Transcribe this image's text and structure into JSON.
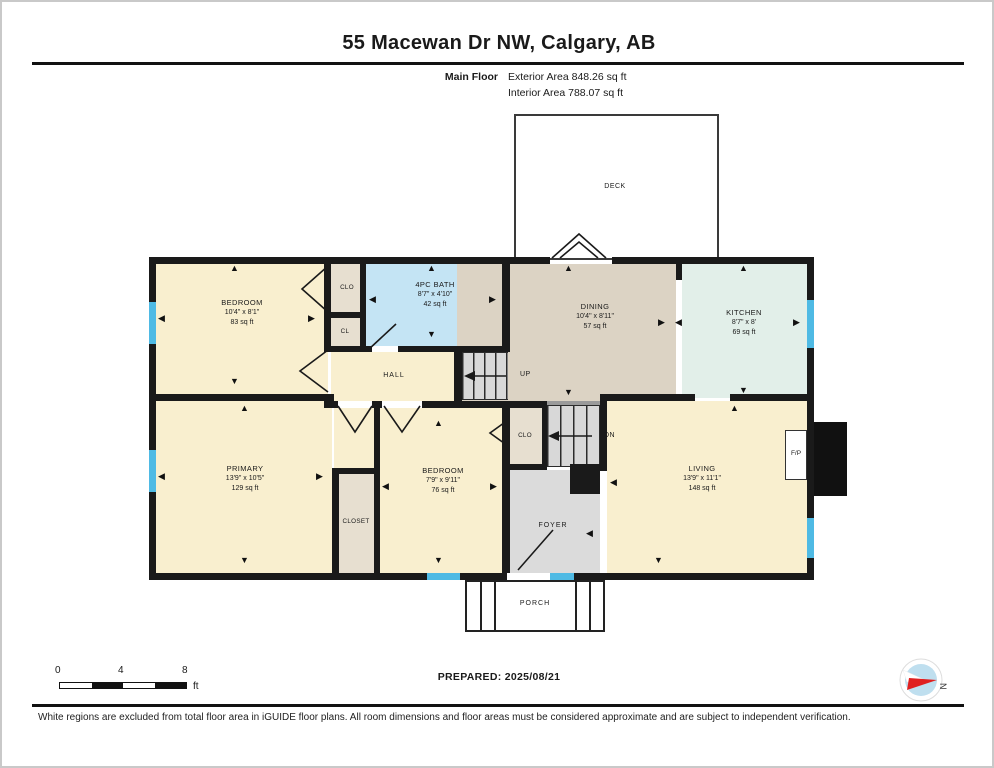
{
  "header": {
    "title": "55 Macewan Dr NW, Calgary, AB",
    "floor_label": "Main Floor",
    "exterior_area": "Exterior Area 848.26 sq ft",
    "interior_area": "Interior Area 788.07 sq ft"
  },
  "rooms": {
    "deck": {
      "name": "DECK"
    },
    "bedroom_top": {
      "name": "BEDROOM",
      "dims": "10'4\" x 8'1\"",
      "area": "83 sq ft"
    },
    "clo_top": {
      "name": "CLO"
    },
    "cl": {
      "name": "CL"
    },
    "bath": {
      "name": "4PC BATH",
      "dims": "8'7\" x 4'10\"",
      "area": "42 sq ft"
    },
    "dining": {
      "name": "DINING",
      "dims": "10'4\" x 8'11\"",
      "area": "57 sq ft"
    },
    "kitchen": {
      "name": "KITCHEN",
      "dims": "8'7\" x 8'",
      "area": "69 sq ft"
    },
    "hall": {
      "name": "HALL"
    },
    "up": {
      "name": "UP"
    },
    "dn": {
      "name": "DN"
    },
    "primary": {
      "name": "PRIMARY",
      "dims": "13'9\" x 10'5\"",
      "area": "129 sq ft"
    },
    "closet": {
      "name": "CLOSET"
    },
    "clo_mid": {
      "name": "CLO"
    },
    "bedroom_mid": {
      "name": "BEDROOM",
      "dims": "7'9\" x 9'11\"",
      "area": "76 sq ft"
    },
    "foyer": {
      "name": "FOYER"
    },
    "living": {
      "name": "LIVING",
      "dims": "13'9\" x 11'1\"",
      "area": "148 sq ft"
    },
    "fireplace": {
      "name": "F/P"
    },
    "porch": {
      "name": "PORCH"
    }
  },
  "footer": {
    "scale": {
      "t0": "0",
      "t4": "4",
      "t8": "8",
      "unit": "ft"
    },
    "prepared": "PREPARED: 2025/08/21",
    "compass_n": "N",
    "disclaimer": "White regions are excluded from total floor area in iGUIDE floor plans. All room dimensions and floor areas must be considered approximate and are subject to independent verification."
  },
  "glyphs": {
    "up": "▲",
    "down": "▼",
    "left": "◀",
    "right": "▶"
  },
  "colors": {
    "wall": "#1a1a1a",
    "room_cream": "#F9EFCF",
    "bath_blue": "#C4E4F4",
    "dining_tan": "#DCD3C4",
    "kitchen_mint": "#E2EFE9",
    "closet_beige": "#E7DFD0",
    "foyer_gray": "#DBDBDB",
    "window_blue": "#4FBAE4",
    "compass_red": "#E02020",
    "compass_blue": "#BFDFEF"
  }
}
